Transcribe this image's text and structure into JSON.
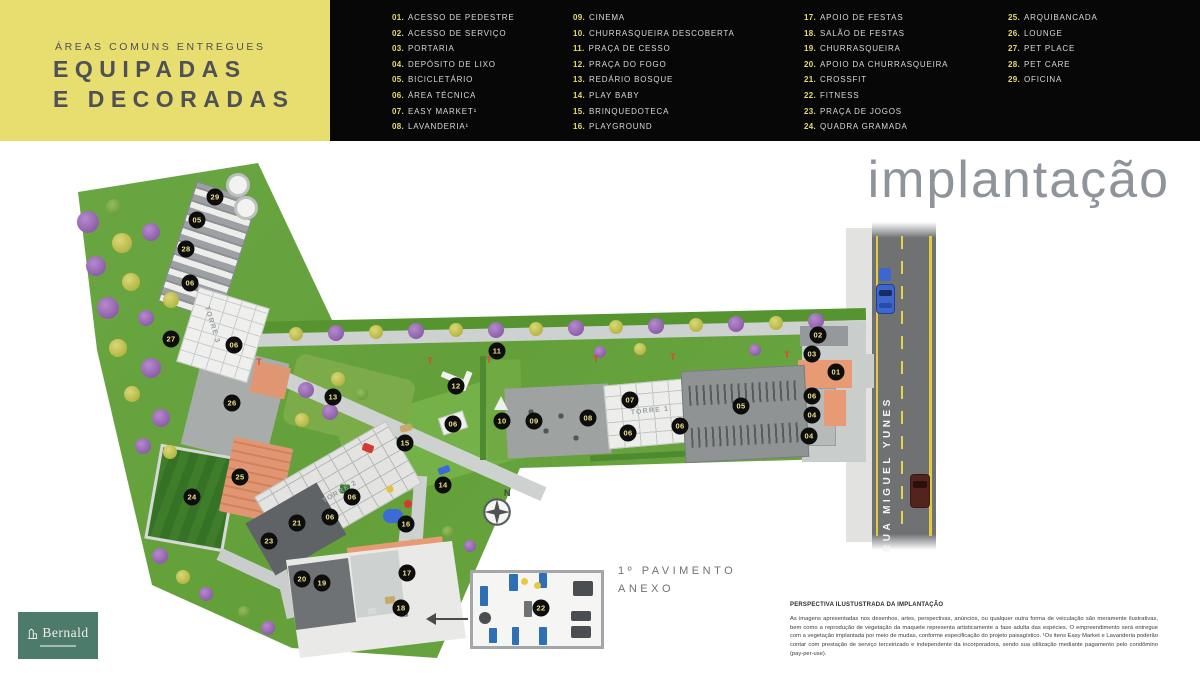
{
  "header": {
    "kicker": "ÁREAS COMUNS ENTREGUES",
    "title_line1": "EQUIPADAS",
    "title_line2": "E DECORADAS"
  },
  "legend": {
    "columns": [
      {
        "items": [
          {
            "num": "01.",
            "label": "ACESSO DE PEDESTRE"
          },
          {
            "num": "02.",
            "label": "ACESSO DE SERVIÇO"
          },
          {
            "num": "03.",
            "label": "PORTARIA"
          },
          {
            "num": "04.",
            "label": "DEPÓSITO DE LIXO"
          },
          {
            "num": "05.",
            "label": "BICICLETÁRIO"
          },
          {
            "num": "06.",
            "label": "ÁREA TÉCNICA"
          },
          {
            "num": "07.",
            "label": "EASY MARKET¹"
          },
          {
            "num": "08.",
            "label": "LAVANDERIA¹"
          }
        ]
      },
      {
        "items": [
          {
            "num": "09.",
            "label": "CINEMA"
          },
          {
            "num": "10.",
            "label": "CHURRASQUEIRA DESCOBERTA"
          },
          {
            "num": "11.",
            "label": "PRAÇA DE CESSO"
          },
          {
            "num": "12.",
            "label": "PRAÇA DO FOGO"
          },
          {
            "num": "13.",
            "label": "REDÁRIO BOSQUE"
          },
          {
            "num": "14.",
            "label": "PLAY BABY"
          },
          {
            "num": "15.",
            "label": "BRINQUEDOTECA"
          },
          {
            "num": "16.",
            "label": "PLAYGROUND"
          }
        ]
      },
      {
        "items": [
          {
            "num": "17.",
            "label": "APOIO DE FESTAS"
          },
          {
            "num": "18.",
            "label": "SALÃO DE FESTAS"
          },
          {
            "num": "19.",
            "label": "CHURRASQUEIRA"
          },
          {
            "num": "20.",
            "label": "APOIO DA CHURRASQUEIRA"
          },
          {
            "num": "21.",
            "label": "CROSSFIT"
          },
          {
            "num": "22.",
            "label": "FITNESS"
          },
          {
            "num": "23.",
            "label": "PRAÇA DE JOGOS"
          },
          {
            "num": "24.",
            "label": "QUADRA GRAMADA"
          }
        ]
      },
      {
        "items": [
          {
            "num": "25.",
            "label": "ARQUIBANCADA"
          },
          {
            "num": "26.",
            "label": "LOUNGE"
          },
          {
            "num": "27.",
            "label": "PET PLACE"
          },
          {
            "num": "28.",
            "label": "PET CARE"
          },
          {
            "num": "29.",
            "label": "OFICINA"
          }
        ]
      }
    ]
  },
  "main": {
    "title": "implantação",
    "road_label": "RUA MIGUEL YUNES",
    "north_label": "N",
    "annex_label_line1": "1º PAVIMENTO",
    "annex_label_line2": "ANEXO"
  },
  "map": {
    "hydrant_glyph": "T",
    "markers": [
      {
        "n": "29",
        "x": 215,
        "y": 197
      },
      {
        "n": "05",
        "x": 197,
        "y": 220
      },
      {
        "n": "28",
        "x": 186,
        "y": 249
      },
      {
        "n": "06",
        "x": 190,
        "y": 283
      },
      {
        "n": "27",
        "x": 171,
        "y": 339
      },
      {
        "n": "06",
        "x": 234,
        "y": 345
      },
      {
        "n": "26",
        "x": 232,
        "y": 403
      },
      {
        "n": "13",
        "x": 333,
        "y": 397
      },
      {
        "n": "11",
        "x": 497,
        "y": 351
      },
      {
        "n": "12",
        "x": 456,
        "y": 386
      },
      {
        "n": "06",
        "x": 453,
        "y": 424
      },
      {
        "n": "15",
        "x": 405,
        "y": 443
      },
      {
        "n": "10",
        "x": 502,
        "y": 421
      },
      {
        "n": "09",
        "x": 534,
        "y": 421
      },
      {
        "n": "08",
        "x": 588,
        "y": 418
      },
      {
        "n": "07",
        "x": 630,
        "y": 400
      },
      {
        "n": "06",
        "x": 628,
        "y": 433
      },
      {
        "n": "06",
        "x": 680,
        "y": 426
      },
      {
        "n": "05",
        "x": 741,
        "y": 406
      },
      {
        "n": "02",
        "x": 818,
        "y": 335
      },
      {
        "n": "03",
        "x": 812,
        "y": 354
      },
      {
        "n": "01",
        "x": 836,
        "y": 372
      },
      {
        "n": "06",
        "x": 812,
        "y": 396
      },
      {
        "n": "04",
        "x": 812,
        "y": 415
      },
      {
        "n": "04",
        "x": 809,
        "y": 436
      },
      {
        "n": "25",
        "x": 240,
        "y": 477
      },
      {
        "n": "24",
        "x": 192,
        "y": 497
      },
      {
        "n": "14",
        "x": 443,
        "y": 485
      },
      {
        "n": "06",
        "x": 352,
        "y": 497
      },
      {
        "n": "06",
        "x": 330,
        "y": 517
      },
      {
        "n": "21",
        "x": 297,
        "y": 523
      },
      {
        "n": "16",
        "x": 406,
        "y": 524
      },
      {
        "n": "23",
        "x": 269,
        "y": 541
      },
      {
        "n": "20",
        "x": 302,
        "y": 579
      },
      {
        "n": "19",
        "x": 322,
        "y": 583
      },
      {
        "n": "17",
        "x": 407,
        "y": 573
      },
      {
        "n": "18",
        "x": 401,
        "y": 608
      },
      {
        "n": "22",
        "x": 541,
        "y": 608
      }
    ],
    "towers": [
      {
        "label": "TORRE 1",
        "x": 650,
        "y": 411,
        "rot": -6
      },
      {
        "label": "TORRE 2",
        "x": 340,
        "y": 492,
        "rot": -30
      },
      {
        "label": "TORRE 3",
        "x": 212,
        "y": 325,
        "rot": 73
      }
    ],
    "hydrants": [
      [
        259,
        362
      ],
      [
        430,
        361
      ],
      [
        489,
        360
      ],
      [
        596,
        359
      ],
      [
        673,
        357
      ],
      [
        787,
        355
      ]
    ],
    "tanks": [
      [
        238,
        185
      ],
      [
        246,
        208
      ]
    ],
    "trees": [
      [
        88,
        222,
        11,
        "p"
      ],
      [
        114,
        207,
        8,
        "g"
      ],
      [
        122,
        243,
        10,
        "y"
      ],
      [
        151,
        232,
        9,
        "p"
      ],
      [
        96,
        266,
        10,
        "p"
      ],
      [
        131,
        282,
        9,
        "y"
      ],
      [
        108,
        308,
        11,
        "p"
      ],
      [
        146,
        318,
        8,
        "p"
      ],
      [
        171,
        300,
        8,
        "y"
      ],
      [
        118,
        348,
        9,
        "y"
      ],
      [
        151,
        368,
        10,
        "p"
      ],
      [
        132,
        394,
        8,
        "y"
      ],
      [
        161,
        418,
        9,
        "p"
      ],
      [
        143,
        446,
        8,
        "p"
      ],
      [
        170,
        452,
        7,
        "y"
      ],
      [
        160,
        556,
        8,
        "p"
      ],
      [
        183,
        577,
        7,
        "y"
      ],
      [
        206,
        594,
        7,
        "p"
      ],
      [
        244,
        612,
        6,
        "g"
      ],
      [
        268,
        628,
        7,
        "p"
      ],
      [
        296,
        334,
        7,
        "y"
      ],
      [
        336,
        333,
        8,
        "p"
      ],
      [
        376,
        332,
        7,
        "y"
      ],
      [
        416,
        331,
        8,
        "p"
      ],
      [
        456,
        330,
        7,
        "y"
      ],
      [
        496,
        330,
        8,
        "p"
      ],
      [
        536,
        329,
        7,
        "y"
      ],
      [
        576,
        328,
        8,
        "p"
      ],
      [
        616,
        327,
        7,
        "y"
      ],
      [
        656,
        326,
        8,
        "p"
      ],
      [
        696,
        325,
        7,
        "y"
      ],
      [
        736,
        324,
        8,
        "p"
      ],
      [
        776,
        323,
        7,
        "y"
      ],
      [
        816,
        321,
        8,
        "p"
      ],
      [
        306,
        390,
        8,
        "p"
      ],
      [
        338,
        379,
        7,
        "y"
      ],
      [
        302,
        420,
        7,
        "y"
      ],
      [
        330,
        412,
        8,
        "p"
      ],
      [
        362,
        394,
        6,
        "g"
      ],
      [
        600,
        352,
        6,
        "p"
      ],
      [
        640,
        349,
        6,
        "y"
      ],
      [
        755,
        350,
        6,
        "p"
      ],
      [
        448,
        532,
        6,
        "g"
      ],
      [
        470,
        546,
        6,
        "p"
      ]
    ],
    "specks": [
      [
        368,
        448,
        11,
        8,
        "#D23B2F",
        20,
        2
      ],
      [
        406,
        428,
        12,
        7,
        "#C9A86A",
        -15,
        2
      ],
      [
        393,
        516,
        20,
        14,
        "#3B6BD6",
        0,
        7
      ],
      [
        408,
        504,
        8,
        8,
        "#D23B2F",
        0,
        4
      ],
      [
        390,
        489,
        7,
        7,
        "#E3C23F",
        0,
        3
      ],
      [
        345,
        489,
        10,
        9,
        "#2F7A2A",
        0,
        2
      ],
      [
        444,
        470,
        12,
        7,
        "#3B6BD6",
        -20,
        2
      ],
      [
        452,
        378,
        22,
        6,
        "#F2F3F1",
        22,
        1
      ],
      [
        466,
        381,
        6,
        20,
        "#F2F3F1",
        22,
        1
      ],
      [
        531,
        412,
        5,
        5,
        "#50545E",
        0,
        2
      ],
      [
        546,
        431,
        5,
        5,
        "#50545E",
        0,
        2
      ],
      [
        561,
        416,
        5,
        5,
        "#50545E",
        0,
        2
      ],
      [
        576,
        438,
        5,
        5,
        "#50545E",
        0,
        2
      ],
      [
        390,
        600,
        10,
        7,
        "#C9A86A",
        -7,
        1
      ],
      [
        404,
        614,
        8,
        6,
        "#8E9294",
        -7,
        1
      ],
      [
        372,
        611,
        8,
        6,
        "#D8DBD9",
        -7,
        1
      ]
    ],
    "gym_items": [
      [
        480,
        586,
        8,
        20,
        "#2F6FB5",
        1
      ],
      [
        509,
        574,
        9,
        17,
        "#2F6FB5",
        1
      ],
      [
        539,
        573,
        8,
        15,
        "#2F6FB5",
        1
      ],
      [
        489,
        628,
        8,
        15,
        "#2F6FB5",
        1
      ],
      [
        512,
        627,
        7,
        18,
        "#2F6FB5",
        1
      ],
      [
        539,
        627,
        8,
        18,
        "#2F6FB5",
        1
      ],
      [
        573,
        581,
        20,
        15,
        "#4A4E50",
        2
      ],
      [
        571,
        611,
        20,
        10,
        "#4A4E50",
        2
      ],
      [
        571,
        626,
        20,
        12,
        "#4A4E50",
        2
      ],
      [
        479,
        612,
        12,
        12,
        "#4A4E50",
        6
      ],
      [
        524,
        601,
        8,
        16,
        "#6E7274",
        1
      ],
      [
        521,
        578,
        7,
        7,
        "#E8C93E",
        4
      ],
      [
        534,
        582,
        7,
        7,
        "#E8C93E",
        4
      ]
    ]
  },
  "footer": {
    "disclaimer_title": "PERSPECTIVA ILUSTUSTRADA DA IMPLANTAÇÃO",
    "disclaimer_body": "As imagens apresentadas nos desenhos, artes, perspectivas, anúncios, ou qualquer outra forma de veiculação são meramente ilustrativas, bem como a reprodução de vegetação da maquete representa artisticamente a fase adulta das espécies. O empreendimento será entregue com a vegetação implantada por meio de mudas, conforme especificação do projeto paisagístico. ¹Os itens Easy Market e Lavanderia poderão contar com prestação de serviço terceirizado e independente da incorporadora, sendo sua utilização mediante pagamento pelo condômino (pay-per-use).",
    "logo_text": "Bernald"
  },
  "colors": {
    "accent_yellow": "#E8DD6F",
    "panel_black": "#070707",
    "legend_number_yellow": "#E6DB6C",
    "marker_bg": "#0D0D0D",
    "marker_text": "#EFE387",
    "title_gray": "#8E949A",
    "brand_green": "#4C7A6B",
    "grass_green": "#67A33F",
    "road_gray": "#6F7173"
  }
}
